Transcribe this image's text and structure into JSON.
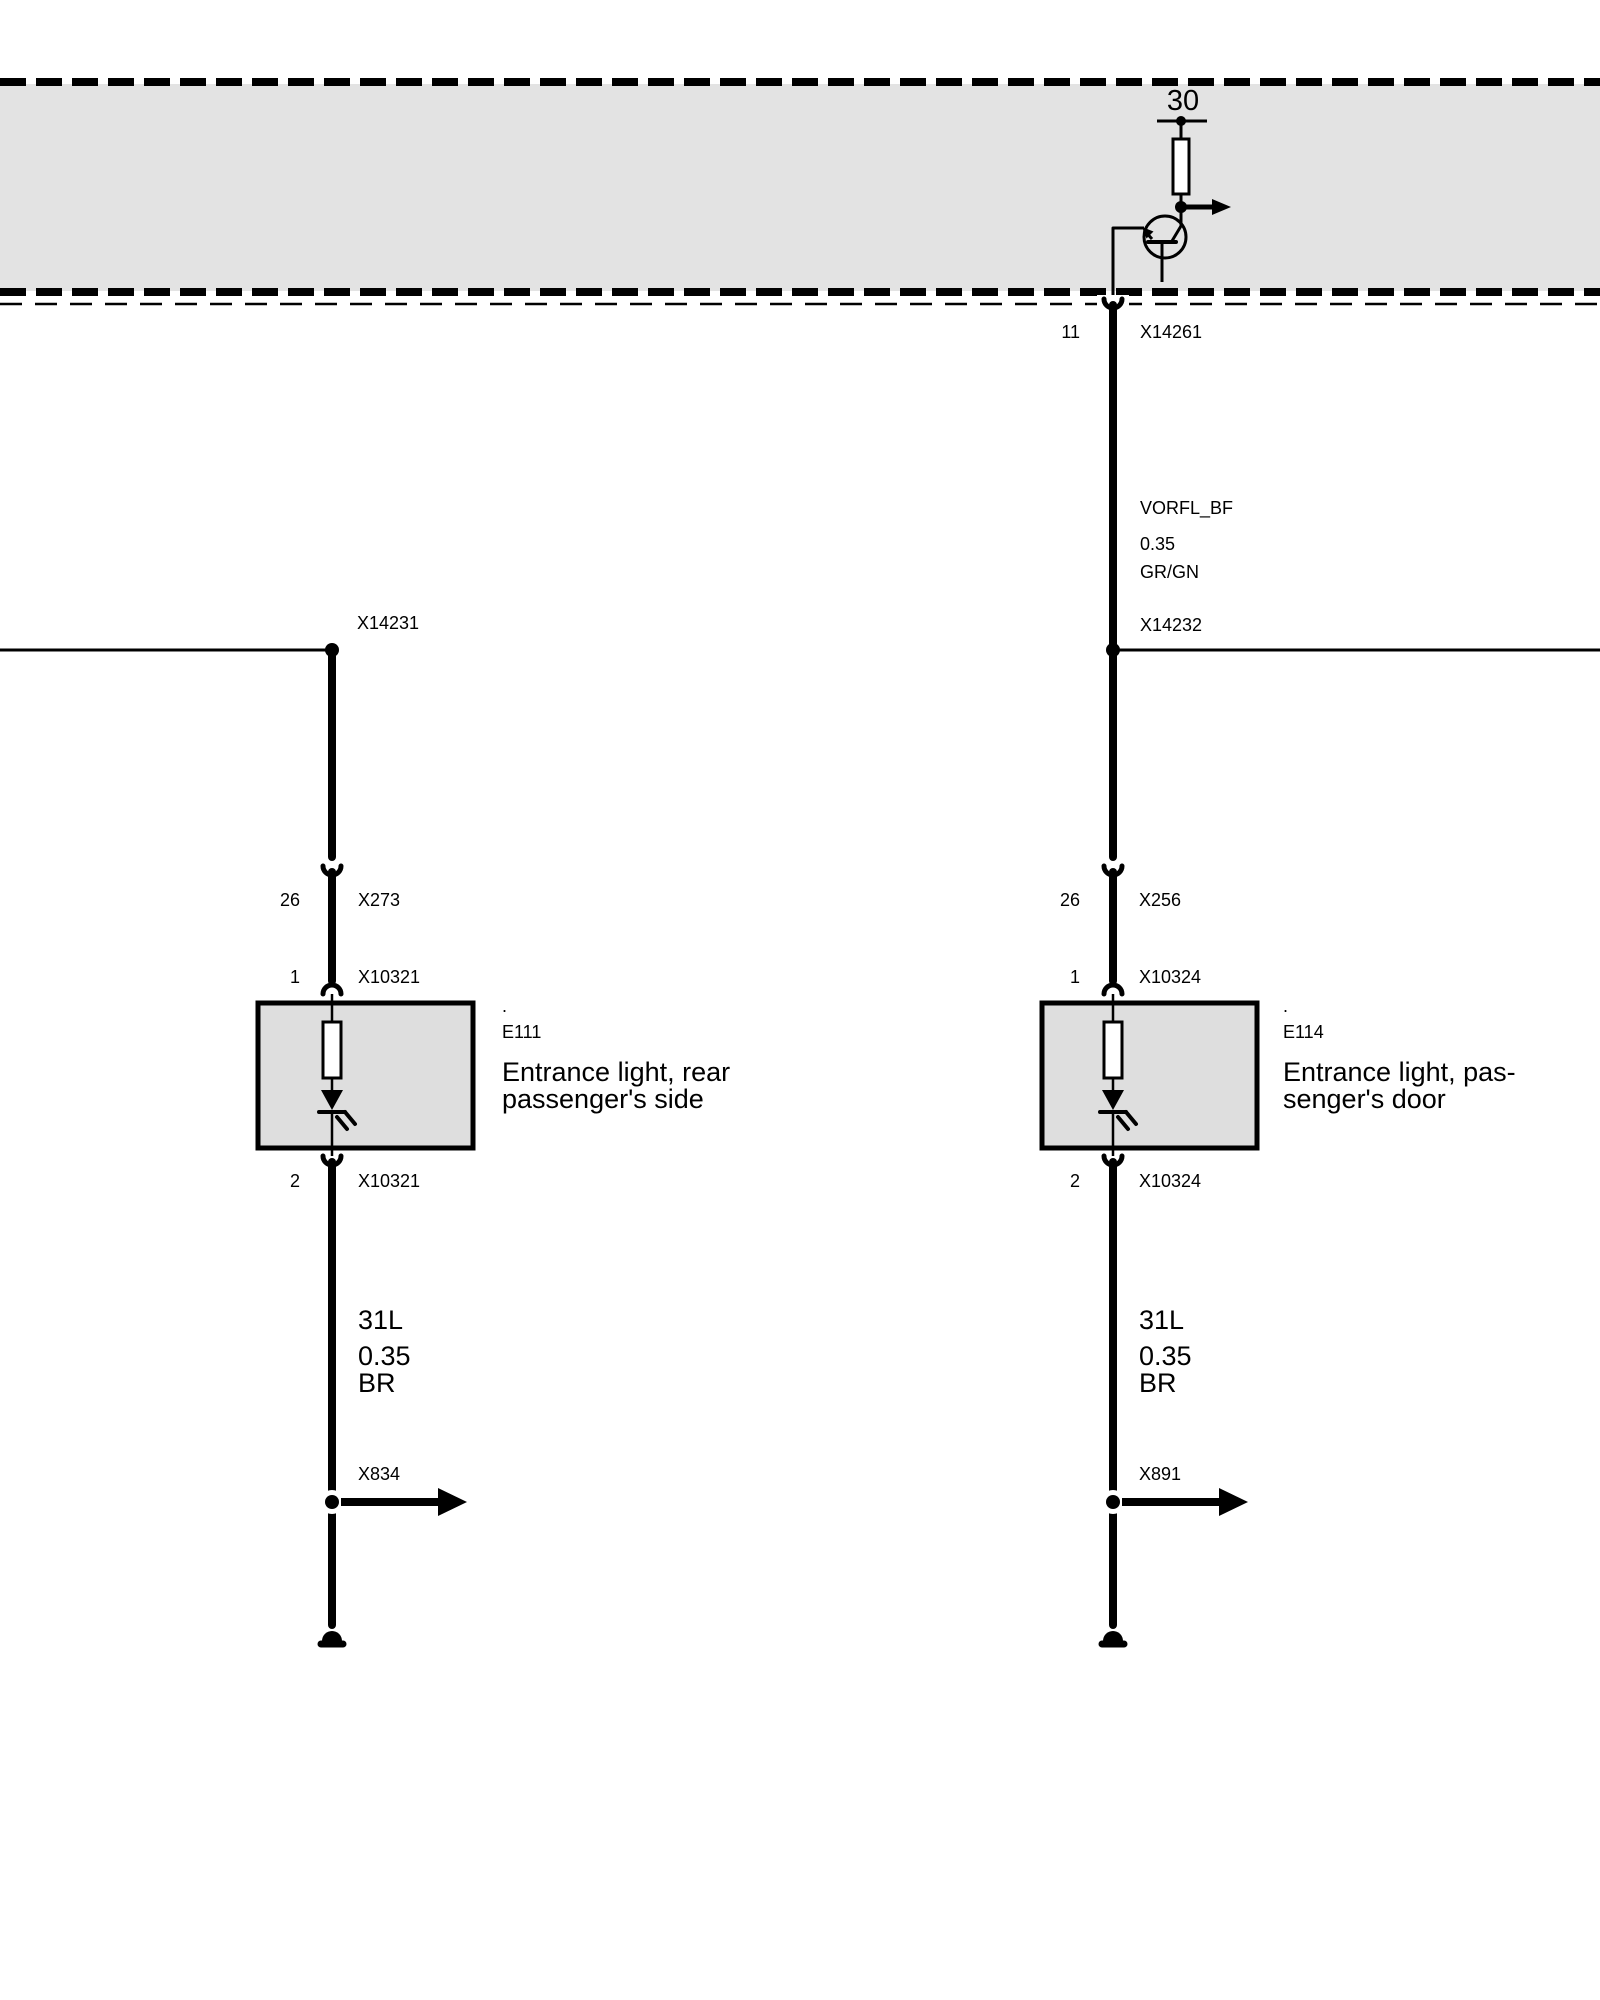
{
  "module": {
    "terminal": "30"
  },
  "colors": {
    "band_fill": "#e3e3e3",
    "box_fill": "#dedede",
    "line": "#000000"
  },
  "right": {
    "module_pin": "11",
    "module_connector": "X14261",
    "signal": "VORFL_BF",
    "signal_gauge": "0.35",
    "signal_color": "GR/GN",
    "junction_label": "X14232",
    "inline_pin": "26",
    "inline_connector": "X256",
    "lamp_pin_in": "1",
    "lamp_connector_in": "X10324",
    "dot": ".",
    "lamp_id": "E114",
    "lamp_name1": "Entrance light, pas-",
    "lamp_name2": "senger's door",
    "lamp_pin_out": "2",
    "lamp_connector_out": "X10324",
    "wire_code": "31L",
    "wire_gauge": "0.35",
    "wire_color": "BR",
    "splice": "X891"
  },
  "left": {
    "junction_label": "X14231",
    "inline_pin": "26",
    "inline_connector": "X273",
    "lamp_pin_in": "1",
    "lamp_connector_in": "X10321",
    "dot": ".",
    "lamp_id": "E111",
    "lamp_name1": "Entrance light, rear",
    "lamp_name2": "passenger's side",
    "lamp_pin_out": "2",
    "lamp_connector_out": "X10321",
    "wire_code": "31L",
    "wire_gauge": "0.35",
    "wire_color": "BR",
    "splice": "X834"
  }
}
